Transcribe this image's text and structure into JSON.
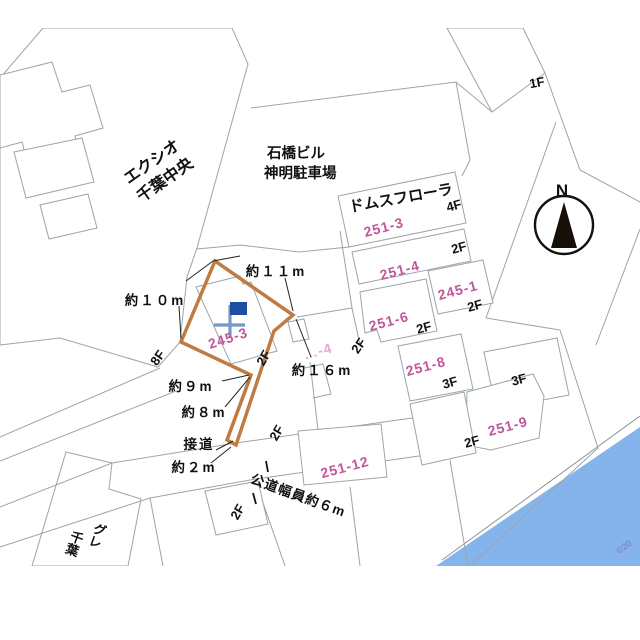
{
  "colors": {
    "highlight": "#bf7b42",
    "water": "#85b4ec",
    "building_fill": "#e4f1f9",
    "parcel_number": "#c2569c",
    "flag": "#1c4fa1",
    "flag_pole": "#7898c6"
  },
  "compass": {
    "label": "N"
  },
  "buildings": {
    "exio_line1": "エクシオ",
    "exio_line2": "千葉中央",
    "ishibashi_line1": "石橋ビル",
    "ishibashi_line2": "神明駐車場",
    "domus": "ドムスフローラ",
    "gre_line1": "グレ",
    "gre_line2": "千葉"
  },
  "floors": {
    "f1": "1F",
    "f2": "2F",
    "f3": "3F",
    "f4": "4F",
    "f8": "8F"
  },
  "parcels": {
    "subject": "245-3",
    "p251_3": "251-3",
    "p251_4": "251-4",
    "p245_1": "245-1",
    "p251_6": "251-6",
    "p251_8": "251-8",
    "p251_9": "251-9",
    "p251_12": "251-12",
    "partial": "…-4"
  },
  "measurements": {
    "top_right": "約１１m",
    "top_left": "約１０m",
    "left": "約９m",
    "lower_left": "約８m",
    "right": "約１６m",
    "frontage_label": "接道",
    "frontage": "約２m",
    "road_width": "公道幅員約６m"
  },
  "copyright": "©20"
}
